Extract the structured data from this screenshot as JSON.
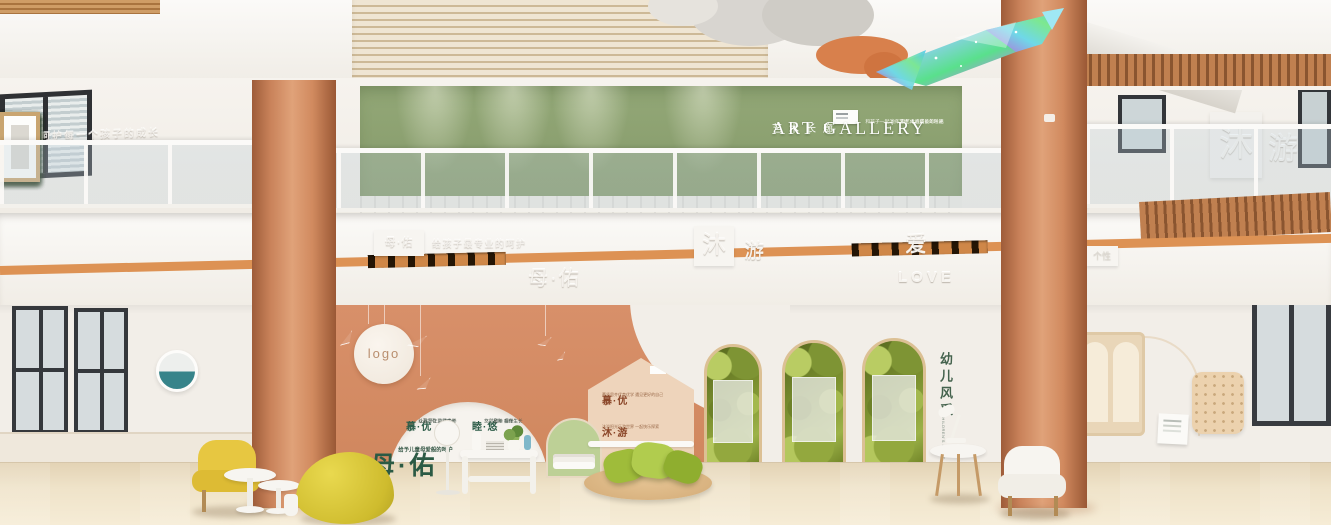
{
  "scene_description": "3D render of a two-storey children's centre lobby with art gallery",
  "colors": {
    "terracotta": "#d28a60",
    "sage_green": "#8ca272",
    "accent_yellow": "#e5c33e",
    "leaf_green": "#9ab93f",
    "wood": "#c9a876",
    "floor_beige": "#ecdcc0"
  },
  "gallery": {
    "title": "ART GALLERY",
    "subtitle": "艺术长廊",
    "tagline1": "用艺术点亮童年时光",
    "tagline2": "和孩子一起演绎艺术 体验成长的乐趣"
  },
  "upper": {
    "left_wall": "用心呵护每一个孩子的成长",
    "right_boxed": "沐",
    "right_char": "游"
  },
  "band": {
    "left_badge": "母·佑",
    "left_caption": "给孩子最专业的呵护",
    "center_boxed": "沐",
    "center_char": "游",
    "love_cn": "爱",
    "love_en": "LOVE",
    "brand": "母·佑",
    "right_char": "南",
    "right_letters": "MUYOU",
    "right_tag": "个性"
  },
  "lower": {
    "logo": "logo",
    "dome_t1": "慕·优",
    "dome_l1a": "以慕为引 以优为养",
    "dome_l1b": "让孩子在爱里成长",
    "dome_t2": "睦·悠",
    "dome_l2a": "和睦 相伴",
    "dome_l2b": "悠然童年 自在生长",
    "house_t1": "慕·优",
    "house_l1": "慕贤思齐优育优学 遇见更好的自己",
    "house_t2": "沐·游",
    "house_l2": "沐浴阳光乐游世界 一起快乐探索",
    "tagline": "给予儿童母爱般的呵护",
    "brand": "母·佑",
    "style_cn": "幼儿风采",
    "style_en": "CHILDREN'S STYLE"
  }
}
